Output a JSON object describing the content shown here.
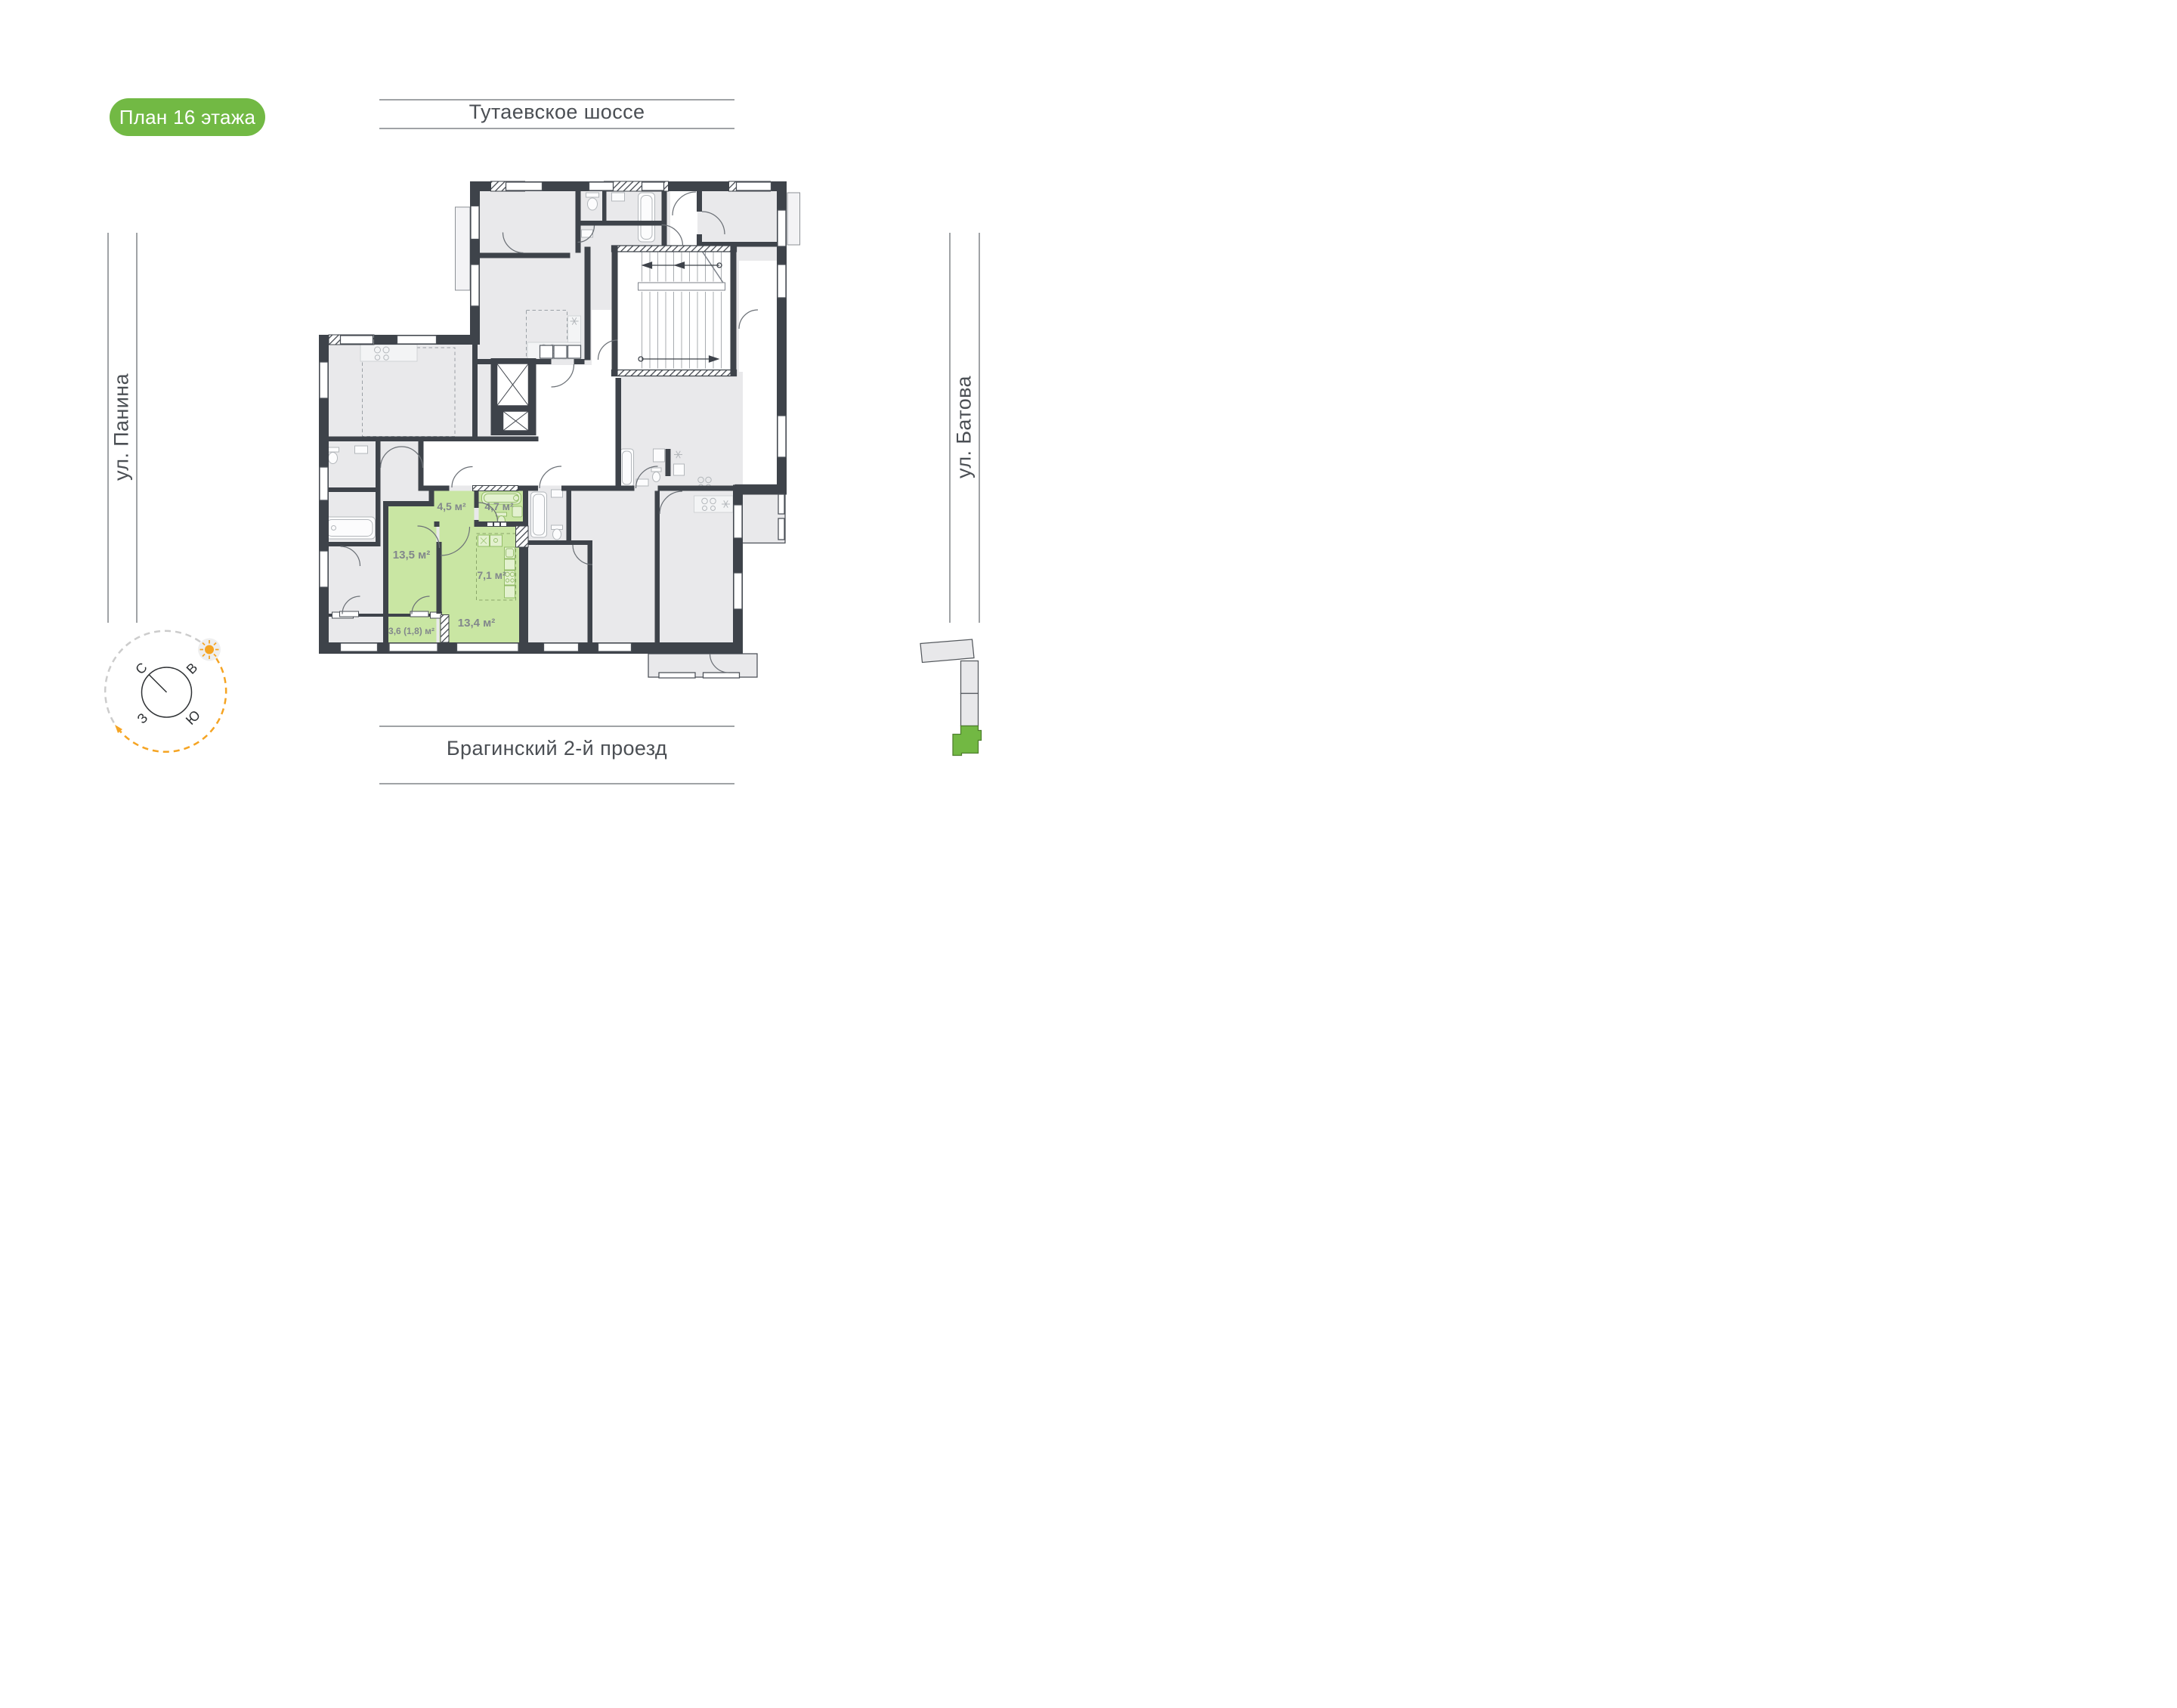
{
  "badge": {
    "label": "План 16 этажа"
  },
  "streets": {
    "top": "Тутаевское шоссе",
    "bottom": "Брагинский 2-й проезд",
    "left": "ул. Панина",
    "right": "ул. Батова"
  },
  "compass": {
    "north": "С",
    "east": "В",
    "south": "Ю",
    "west": "З"
  },
  "plan": {
    "floor_label": "План 16 этажа",
    "highlighted_apartment": {
      "rooms": [
        {
          "name": "hall",
          "area": "4,5 м²"
        },
        {
          "name": "bathroom",
          "area": "4,7 м²"
        },
        {
          "name": "living-room",
          "area": "13,5 м²"
        },
        {
          "name": "kitchen",
          "area": "7,1 м²"
        },
        {
          "name": "kitchen-living-room",
          "area": "13,4 м²"
        },
        {
          "name": "balcony",
          "area": "3,6 (1,8) м²"
        }
      ]
    }
  },
  "colors": {
    "accent_green": "#72b944",
    "apartment_green": "#c9e6a3",
    "wall": "#3e434a",
    "room_gray": "#e9e9eb",
    "compass_orange": "#f5a423"
  }
}
